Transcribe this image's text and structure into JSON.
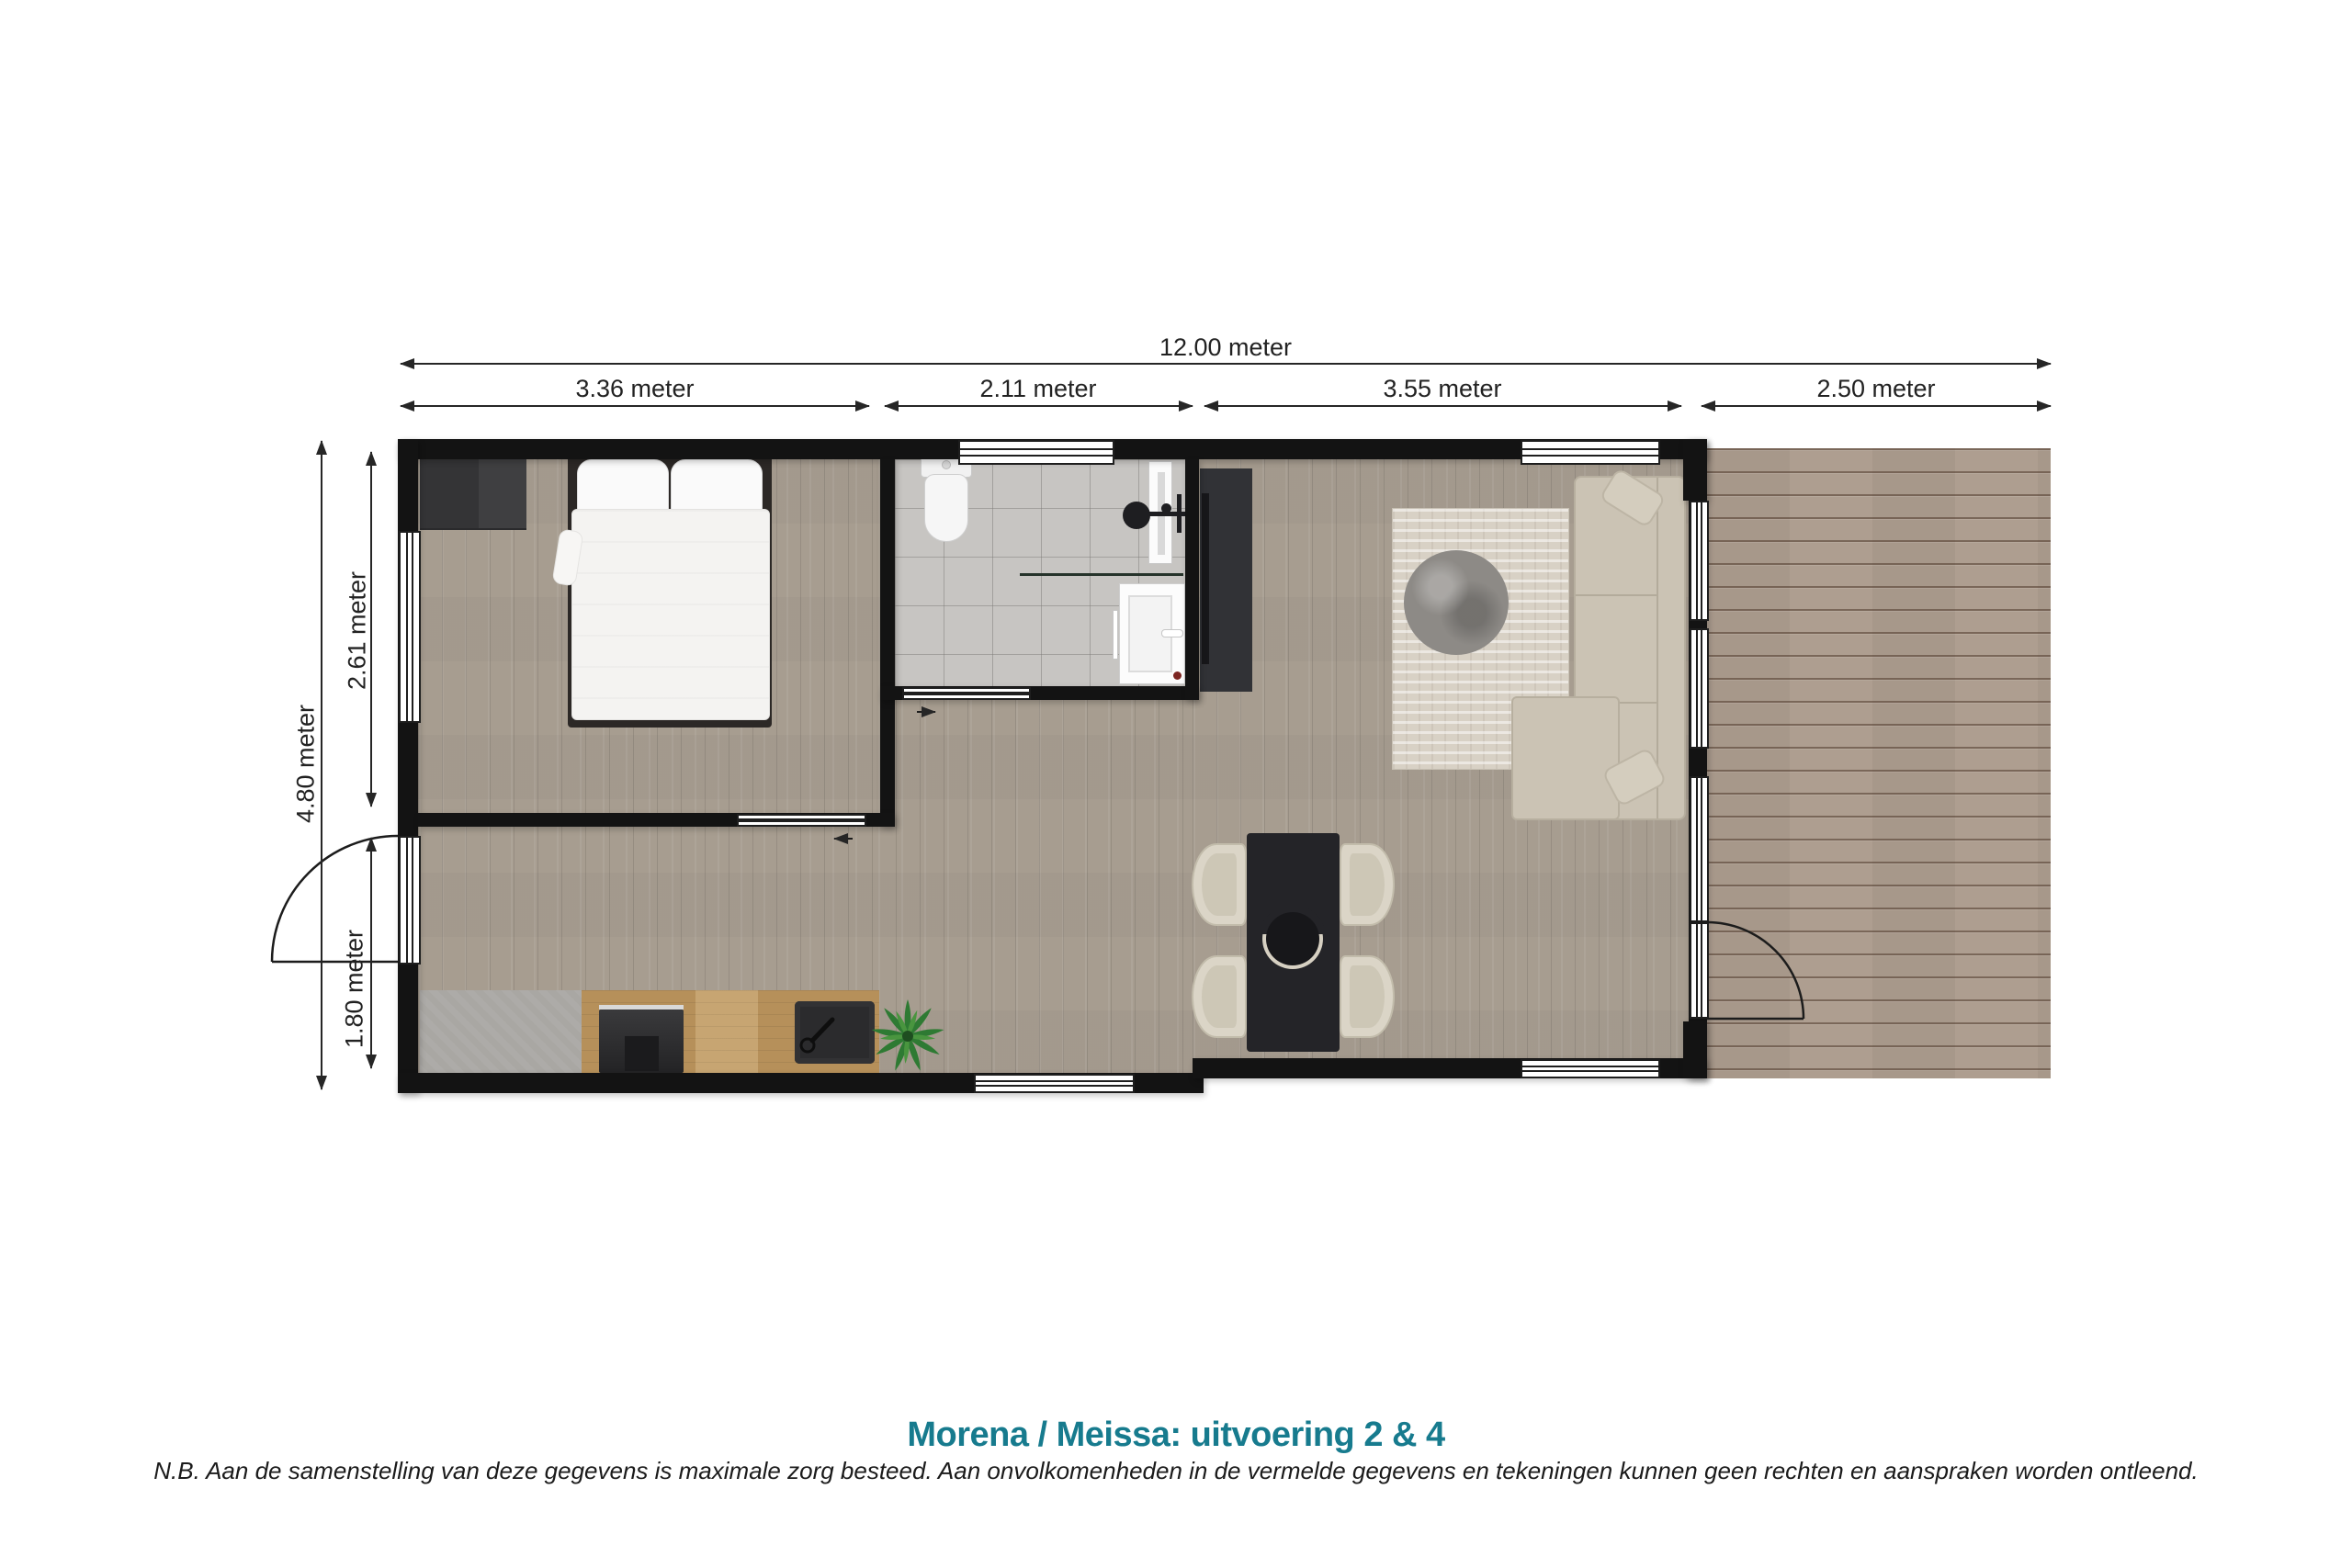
{
  "dimensions": {
    "top_total": "12.00 meter",
    "top_segments": [
      "3.36 meter",
      "2.11 meter",
      "3.55 meter",
      "2.50 meter"
    ],
    "left_total": "4.80 meter",
    "left_segments": [
      "2.61 meter",
      "1.80 meter"
    ]
  },
  "footer": {
    "title": "Morena / Meissa: uitvoering 2 & 4",
    "disclaimer": "N.B. Aan de samenstelling van deze gegevens is maximale zorg besteed. Aan onvolkomenheden in de vermelde gegevens en tekeningen kunnen geen rechten en aanspraken worden ontleend."
  },
  "colors": {
    "title_accent": "#177b8e",
    "wall": "#131313",
    "wood_floor": "#a79d90",
    "bathroom_tile": "#c7c5c2",
    "deck_wood": "#ae9e90",
    "sofa": "#cbc3b4",
    "dining_table": "#242428"
  }
}
